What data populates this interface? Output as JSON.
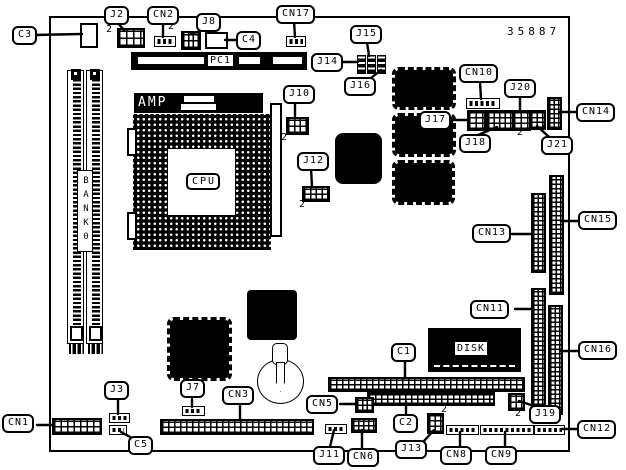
{
  "part_number": "35887",
  "board": {
    "cpu_label": "CPU",
    "amp_label": "AMP",
    "pc1_label": "PC1",
    "disk_label": "DISK",
    "bank_label": "BANK0"
  },
  "markers": {
    "pin2": "2"
  },
  "labels": {
    "c3": "C3",
    "j2": "J2",
    "cn2": "CN2",
    "j8": "J8",
    "c4": "C4",
    "cn17": "CN17",
    "j15": "J15",
    "j14": "J14",
    "j16": "J16",
    "cn10": "CN10",
    "j20": "J20",
    "cn14": "CN14",
    "j17": "J17",
    "j18": "J18",
    "j21": "J21",
    "j10": "J10",
    "j12": "J12",
    "cn13": "CN13",
    "cn15": "CN15",
    "cn11": "CN11",
    "cn16": "CN16",
    "c1": "C1",
    "j19": "J19",
    "cn12": "CN12",
    "cn9": "CN9",
    "cn8": "CN8",
    "j13": "J13",
    "c2": "C2",
    "cn6": "CN6",
    "j11": "J11",
    "cn5": "CN5",
    "cn3": "CN3",
    "j7": "J7",
    "j3": "J3",
    "c5": "C5",
    "cn1": "CN1"
  }
}
